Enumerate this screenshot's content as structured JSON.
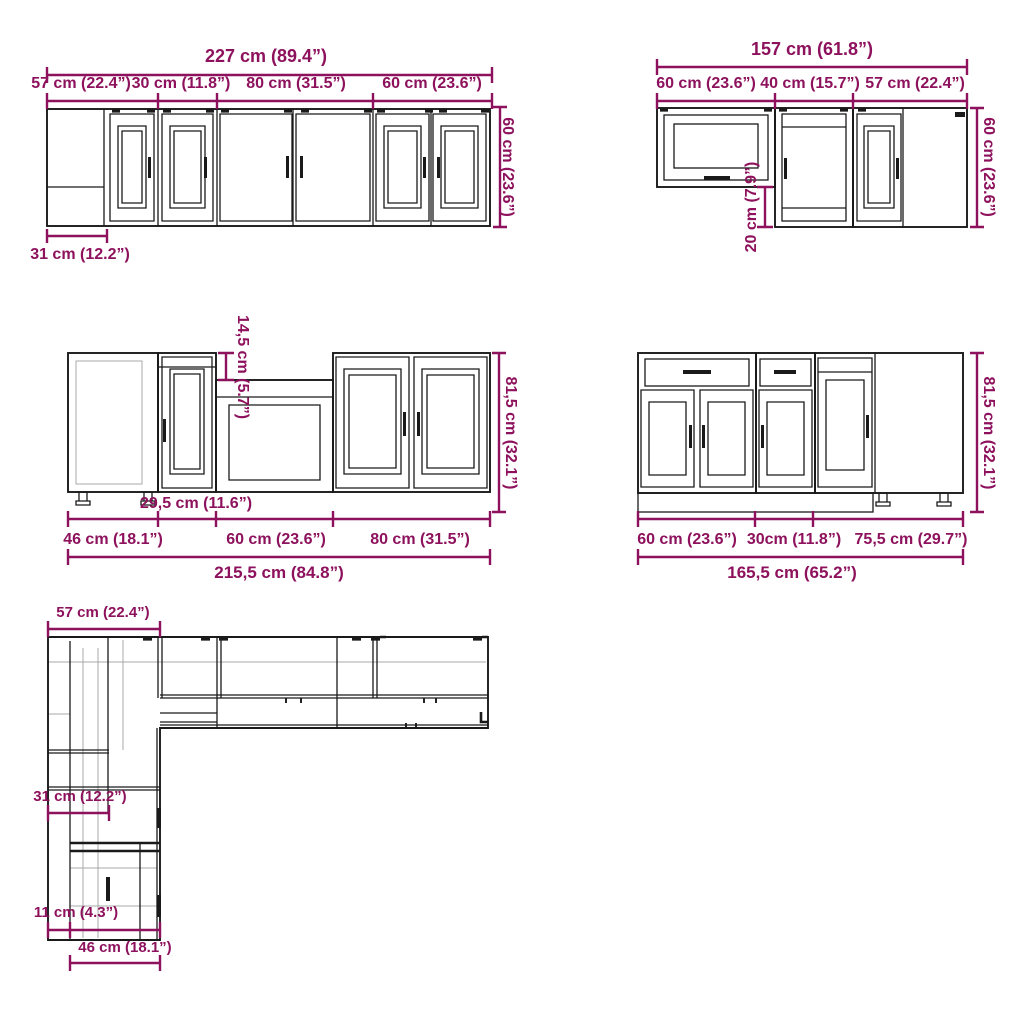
{
  "colors": {
    "dimension": "#8D115C",
    "line": "#1a1a1a",
    "faint": "#a8a8a8",
    "background": "#ffffff"
  },
  "wall_run_left": {
    "total": "227 cm (89.4”)",
    "segments": [
      "57 cm (22.4”)",
      "30 cm (11.8”)",
      "80 cm (31.5”)",
      "60 cm (23.6”)"
    ],
    "height": "60 cm (23.6”)",
    "return_depth": "31 cm (12.2”)"
  },
  "wall_run_right": {
    "total": "157 cm (61.8”)",
    "segments": [
      "60 cm (23.6”)",
      "40 cm (15.7”)",
      "57 cm (22.4”)"
    ],
    "height": "60 cm (23.6”)",
    "drop": "20 cm (7.9”)"
  },
  "base_run_left": {
    "total": "215,5 cm (84.8”)",
    "segments": [
      "46 cm (18.1”)",
      "29,5 cm (11.6”)",
      "60 cm (23.6”)",
      "80 cm (31.5”)"
    ],
    "height": "81,5 cm (32.1”)",
    "recess": "14,5 cm (5.7”)"
  },
  "base_run_right": {
    "total": "165,5 cm (65.2”)",
    "segments": [
      "60 cm (23.6”)",
      "30cm (11.8”)",
      "75,5 cm (29.7”)"
    ],
    "height": "81,5 cm (32.1”)"
  },
  "plan_view": {
    "top_width": "57 cm (22.4”)",
    "wall_depth": "31 cm (12.2”)",
    "side_offset": "11 cm (4.3”)",
    "base_depth": "46 cm (18.1”)"
  }
}
